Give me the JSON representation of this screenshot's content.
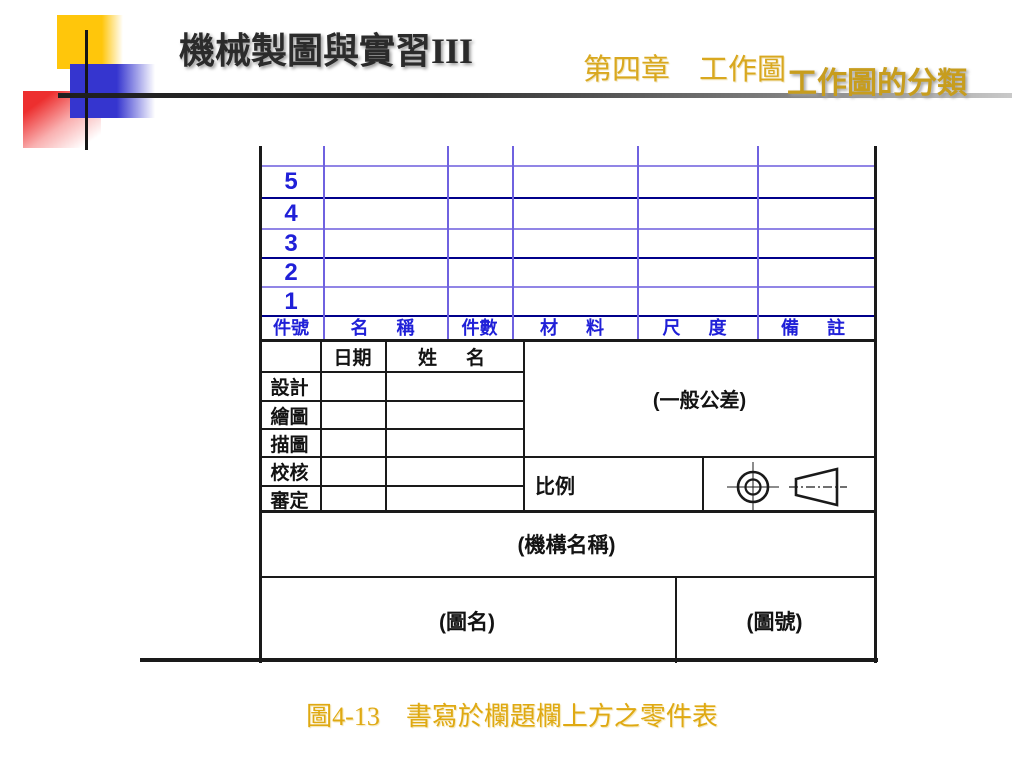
{
  "slide": {
    "course_title": "機械製圖與實習III",
    "chapter_title": "第四章　工作圖",
    "section_title": "工作圖的分類",
    "caption": "圖4-13　書寫於欄題欄上方之零件表"
  },
  "parts_list": {
    "row_numbers": [
      "5",
      "4",
      "3",
      "2",
      "1"
    ],
    "columns": [
      "件號",
      "名　稱",
      "件數",
      "材　料",
      "尺　度",
      "備　註"
    ]
  },
  "title_block": {
    "date_label": "日期",
    "name_label": "姓　名",
    "row_labels": [
      "設計",
      "繪圖",
      "描圖",
      "校核",
      "審定"
    ],
    "tolerance_label": "(一般公差)",
    "scale_label": "比例",
    "organization_label": "(機構名稱)",
    "drawing_name_label": "(圖名)",
    "drawing_number_label": "(圖號)"
  },
  "colors": {
    "accent_yellow": "#ffc60b",
    "accent_blue": "#3535cf",
    "accent_red": "#ed2f2f",
    "parts_list_blue": "#2020d8",
    "grid_light_blue": "#9185e6",
    "grid_navy": "#00008b",
    "gold_text": "#d9a81f",
    "line_black": "#1a1a1a"
  }
}
